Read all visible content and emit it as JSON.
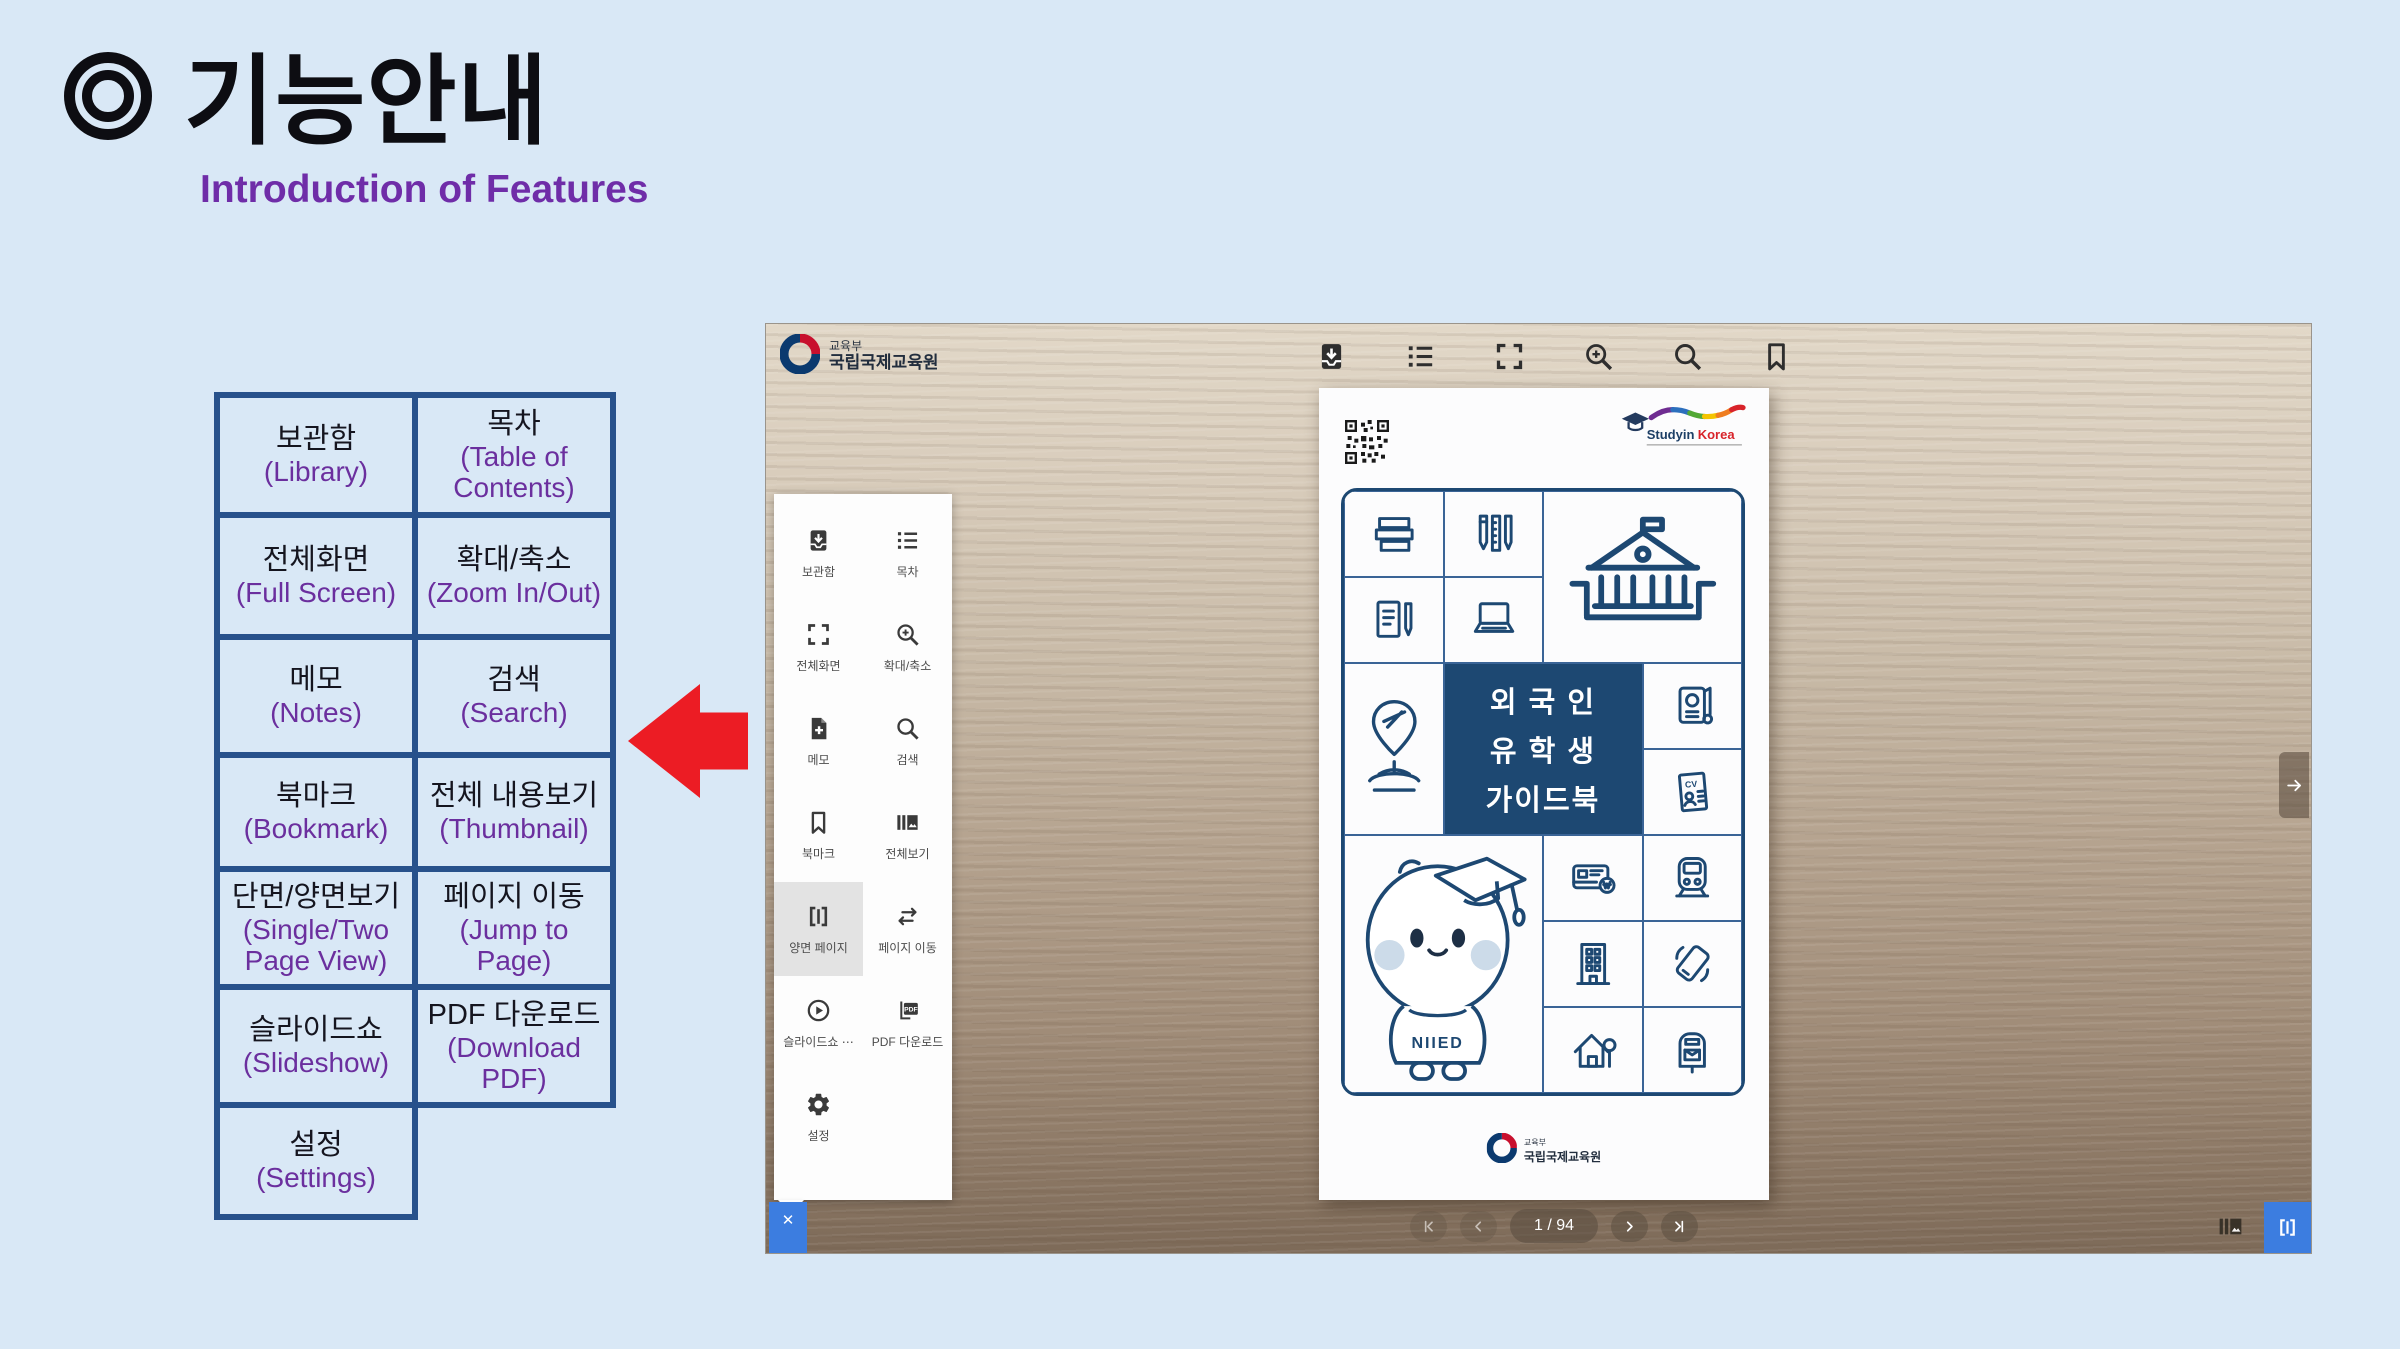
{
  "slide": {
    "title": "기능안내",
    "subtitle": "Introduction of Features",
    "callout_arrow": {
      "direction": "left",
      "color": "#ec1c24"
    }
  },
  "colors": {
    "slide_bg": "#d9e8f6",
    "table_border": "#27518b",
    "korean_text": "#15151f",
    "english_text": "#6b2f9e",
    "accent_blue": "#3c7de0",
    "cover_navy": "#1d4872"
  },
  "feature_table": {
    "rows": [
      [
        {
          "ko": "보관함",
          "en": "(Library)"
        },
        {
          "ko": "목차",
          "en": "(Table of Contents)"
        }
      ],
      [
        {
          "ko": "전체화면",
          "en": "(Full Screen)"
        },
        {
          "ko": "확대/축소",
          "en": "(Zoom In/Out)"
        }
      ],
      [
        {
          "ko": "메모",
          "en": "(Notes)"
        },
        {
          "ko": "검색",
          "en": "(Search)"
        }
      ],
      [
        {
          "ko": "북마크",
          "en": "(Bookmark)"
        },
        {
          "ko": "전체 내용보기",
          "en": "(Thumbnail)"
        }
      ],
      [
        {
          "ko": "단면/양면보기",
          "en": "(Single/Two Page View)"
        },
        {
          "ko": "페이지 이동",
          "en": "(Jump to Page)"
        }
      ],
      [
        {
          "ko": "슬라이드쇼",
          "en": "(Slideshow)"
        },
        {
          "ko": "PDF 다운로드",
          "en": "(Download PDF)"
        }
      ],
      [
        {
          "ko": "설정",
          "en": "(Settings)"
        },
        null
      ]
    ]
  },
  "viewer": {
    "publisher": {
      "ministry": "교육부",
      "institute": "국립국제교육원"
    },
    "toolbar": [
      {
        "icon": "library"
      },
      {
        "icon": "toc"
      },
      {
        "icon": "fullscreen"
      },
      {
        "icon": "zoom"
      },
      {
        "icon": "search"
      },
      {
        "icon": "bookmark"
      }
    ],
    "menu": {
      "items": [
        {
          "icon": "library",
          "label": "보관함"
        },
        {
          "icon": "toc",
          "label": "목차"
        },
        {
          "icon": "fullscreen",
          "label": "전체화면"
        },
        {
          "icon": "zoom",
          "label": "확대/축소"
        },
        {
          "icon": "note",
          "label": "메모"
        },
        {
          "icon": "search",
          "label": "검색"
        },
        {
          "icon": "bookmark",
          "label": "북마크"
        },
        {
          "icon": "thumbnail",
          "label": "전체보기"
        },
        {
          "icon": "twopage",
          "label": "양면 페이지",
          "selected": true
        },
        {
          "icon": "jump",
          "label": "페이지 이동"
        },
        {
          "icon": "slideshow",
          "label": "슬라이드쇼 ⋯"
        },
        {
          "icon": "pdf",
          "label": "PDF 다운로드"
        },
        {
          "icon": "settings",
          "label": "설정"
        }
      ],
      "close": "✕"
    },
    "book": {
      "brand": {
        "part1": "Studyin",
        "part2": "Korea"
      },
      "title_lines": [
        "외 국 인",
        "유 학 생",
        "가이드북"
      ],
      "mascot_text": "NIIED",
      "footer": {
        "ministry": "교육부",
        "institute": "국립국제교육원"
      },
      "cover_cells": [
        "books",
        "stationery",
        "university",
        "document",
        "laptop",
        "pin",
        "title",
        "passport",
        "cv",
        "mascot",
        "card",
        "train",
        "building",
        "phone",
        "house",
        "mailbox"
      ]
    },
    "pagination": {
      "current": "1 / 94"
    }
  }
}
